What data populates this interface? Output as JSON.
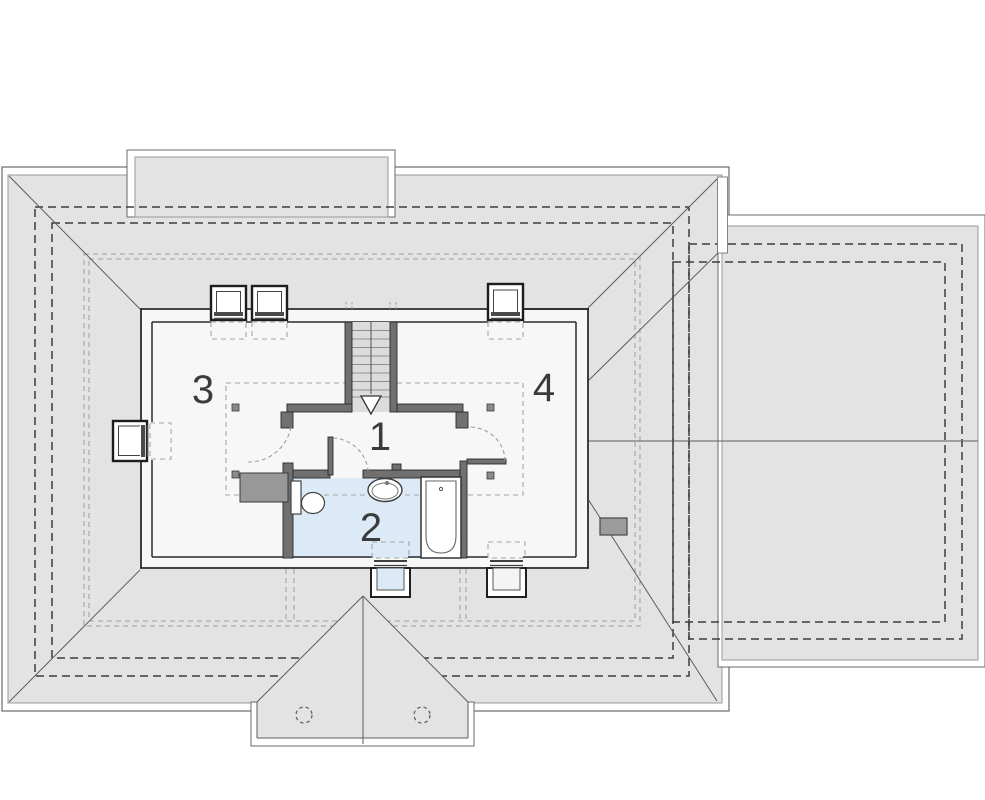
{
  "plan": {
    "type": "attic-roof-floor-plan",
    "rooms": [
      {
        "number": "1"
      },
      {
        "number": "2"
      },
      {
        "number": "3"
      },
      {
        "number": "4"
      }
    ]
  },
  "colors": {
    "page_bg": "#ffffff",
    "roof_surface": "#e3e3e3",
    "surface_edge": "#9a9a9a",
    "fascia_white": "#ffffff",
    "edge_line": "#6a6a6a",
    "hip_line": "#5d5d5d",
    "dash_dark": "#3d3d3d",
    "dash_light": "#9d9d9d",
    "interior_floor": "#f7f7f7",
    "bathroom_floor": "#dbeaf6",
    "stair_floor": "#dcdcdc",
    "wall_fill": "#707070",
    "wall_line": "#2b2b2b",
    "chimney_fill": "#989898",
    "roof_chimney_fill": "#9c9c9c",
    "label_color": "#3b3b3b"
  }
}
